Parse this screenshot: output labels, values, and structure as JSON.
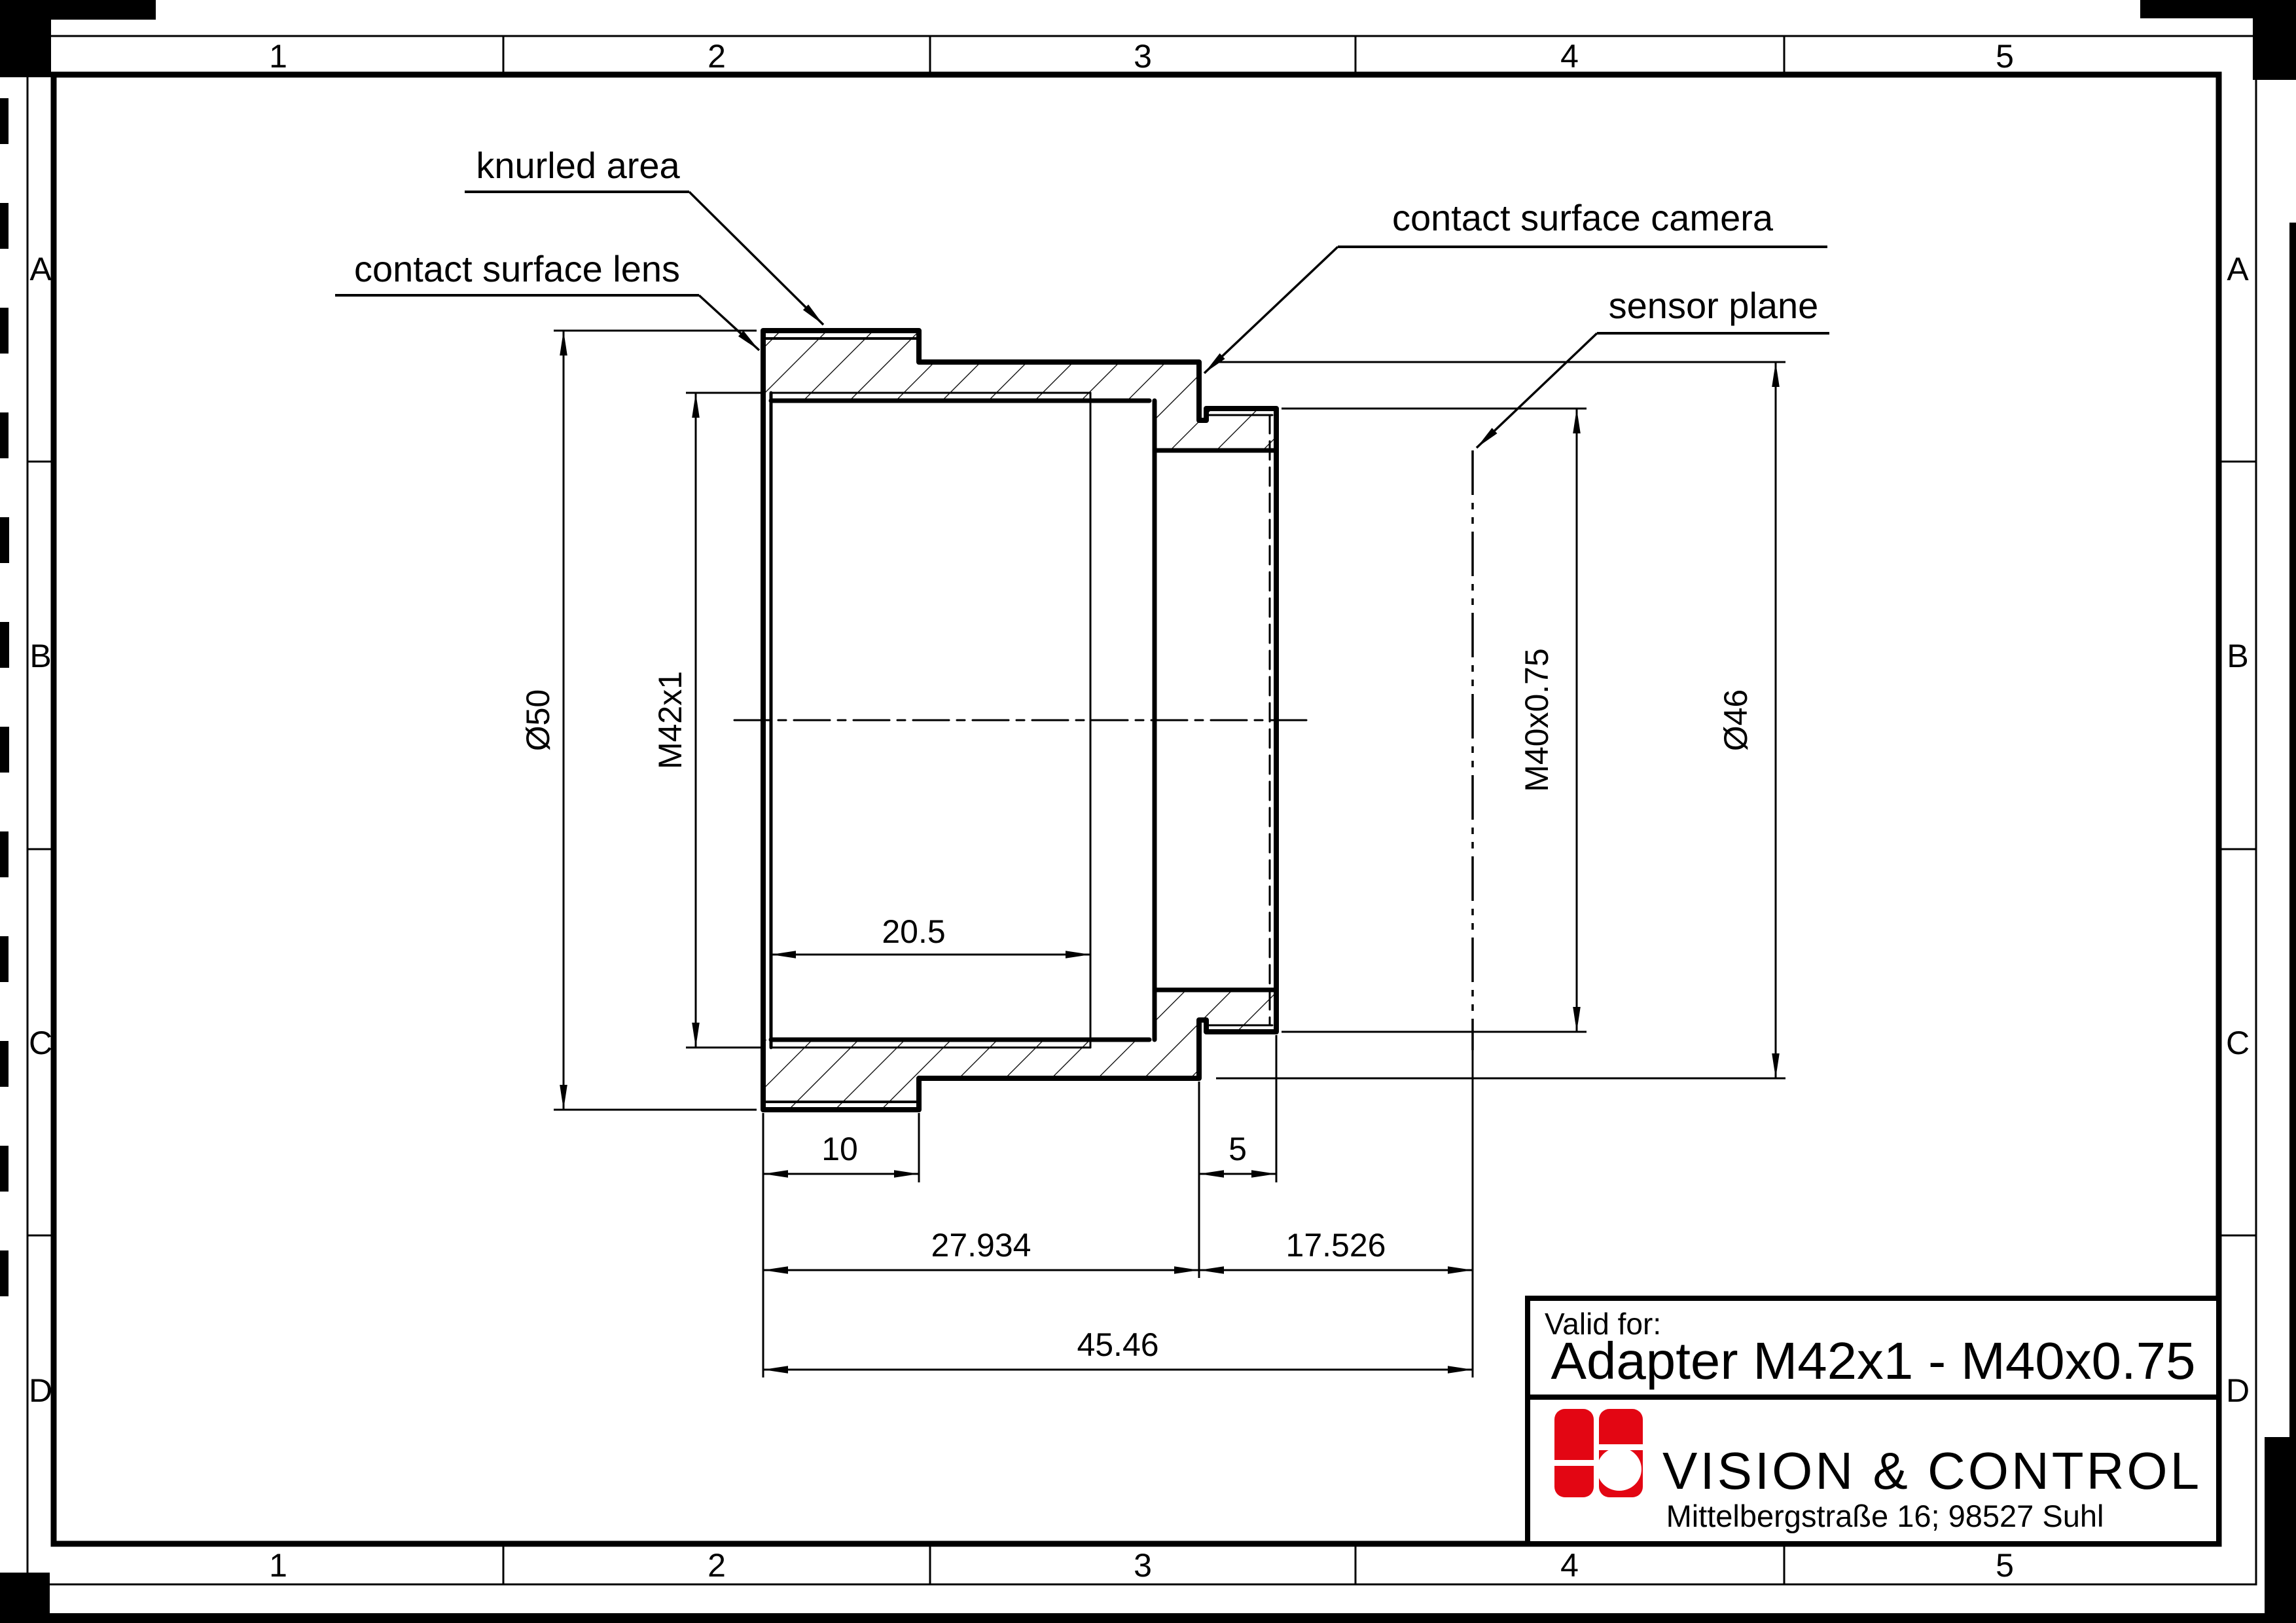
{
  "page": {
    "background": "#ffffff",
    "line_color": "#000000"
  },
  "grid": {
    "columns": [
      "1",
      "2",
      "3",
      "4",
      "5"
    ],
    "rows": [
      "A",
      "B",
      "C",
      "D"
    ]
  },
  "labels": {
    "knurled_area": "knurled area",
    "contact_surface_lens": "contact surface lens",
    "contact_surface_camera": "contact surface camera",
    "sensor_plane": "sensor plane"
  },
  "dimensions": {
    "knurl_diameter": "Ø50",
    "lens_thread": "M42x1",
    "camera_thread": "M40x0.75",
    "body_diameter": "Ø46",
    "lens_thread_depth": "20.5",
    "knurl_width": "10",
    "camera_thread_length": "5",
    "front_to_camera_flange": "27.934",
    "camera_flange_to_sensor": "17.526",
    "front_to_sensor": "45.46"
  },
  "title_block": {
    "valid_for": "Valid for:",
    "part_name": "Adapter M42x1 - M40x0.75",
    "company": "VISION & CONTROL",
    "address": "Mittelbergstraße 16; 98527 Suhl",
    "logo_color": "#e30613"
  }
}
